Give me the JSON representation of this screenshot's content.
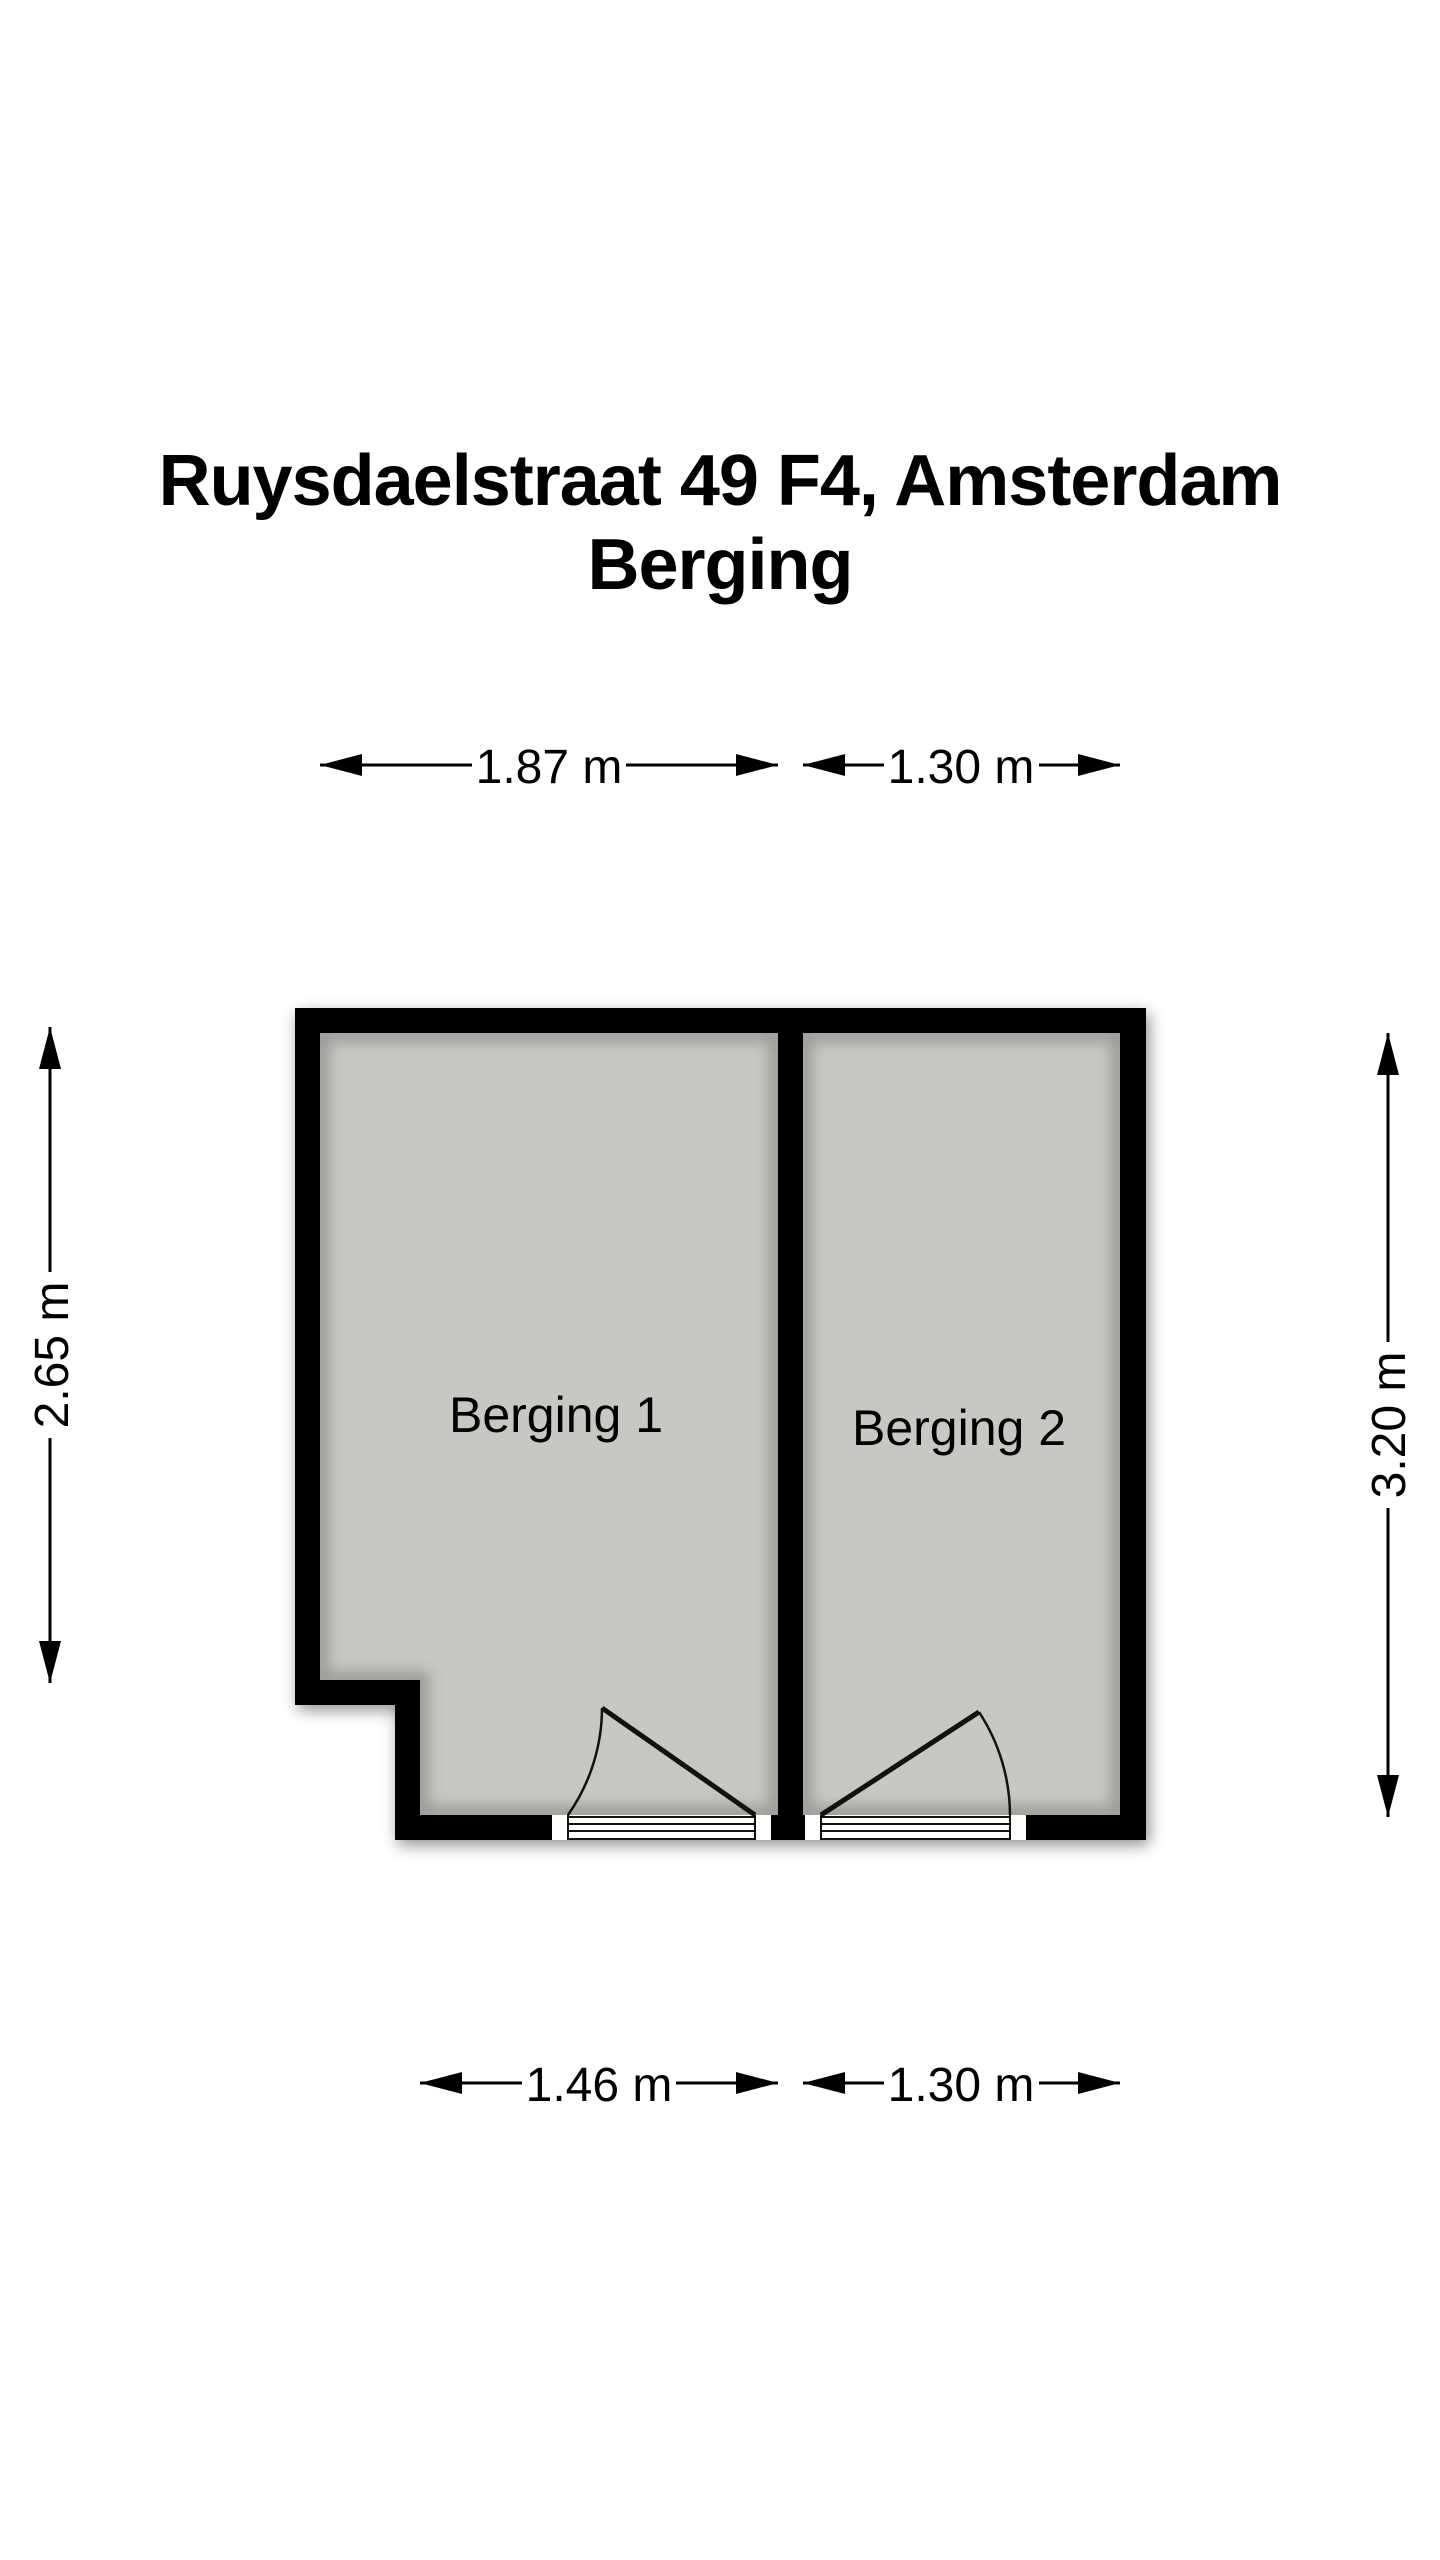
{
  "title": {
    "line1": "Ruysdaelstraat 49 F4, Amsterdam",
    "line2": "Berging"
  },
  "rooms": [
    {
      "name": "Berging 1"
    },
    {
      "name": "Berging 2"
    }
  ],
  "dimensions": {
    "top": [
      {
        "label": "1.87 m"
      },
      {
        "label": "1.30 m"
      }
    ],
    "bottom": [
      {
        "label": "1.46 m"
      },
      {
        "label": "1.30 m"
      }
    ],
    "left": {
      "label": "2.65 m"
    },
    "right": {
      "label": "3.20 m"
    }
  },
  "colors": {
    "wall": "#000000",
    "floor": "#c6c8c1",
    "background": "#ffffff",
    "text": "#000000"
  }
}
